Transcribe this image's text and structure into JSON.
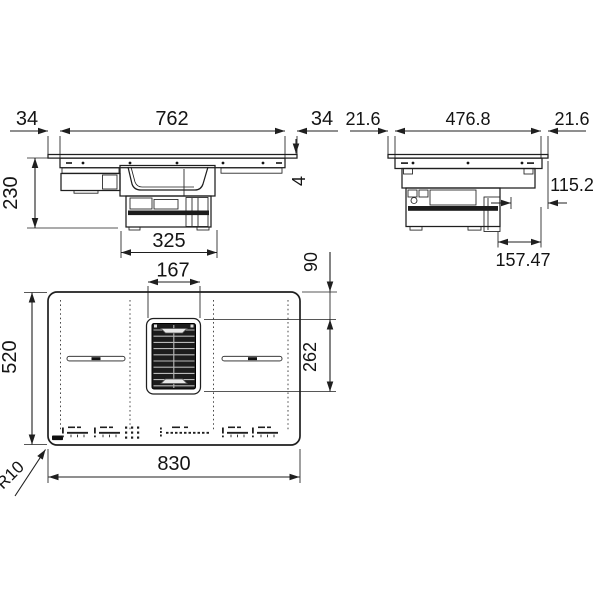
{
  "drawing_type": "hob-installation-drawing",
  "views": {
    "front": {
      "dims": {
        "overhang_left": "34",
        "body_width": "762",
        "overhang_right": "34",
        "height": "230",
        "glass_thickness": "4",
        "duct_width": "325"
      }
    },
    "side": {
      "dims": {
        "overhang_front": "21.6",
        "body_depth": "476.8",
        "overhang_rear": "21.6",
        "duct_clearance": "115.2",
        "duct_depth": "157.47"
      }
    },
    "top": {
      "dims": {
        "vent_width": "167",
        "vent_offset_top": "90",
        "depth": "520",
        "vent_length": "262",
        "width": "830",
        "corner_radius": "R10"
      }
    }
  }
}
